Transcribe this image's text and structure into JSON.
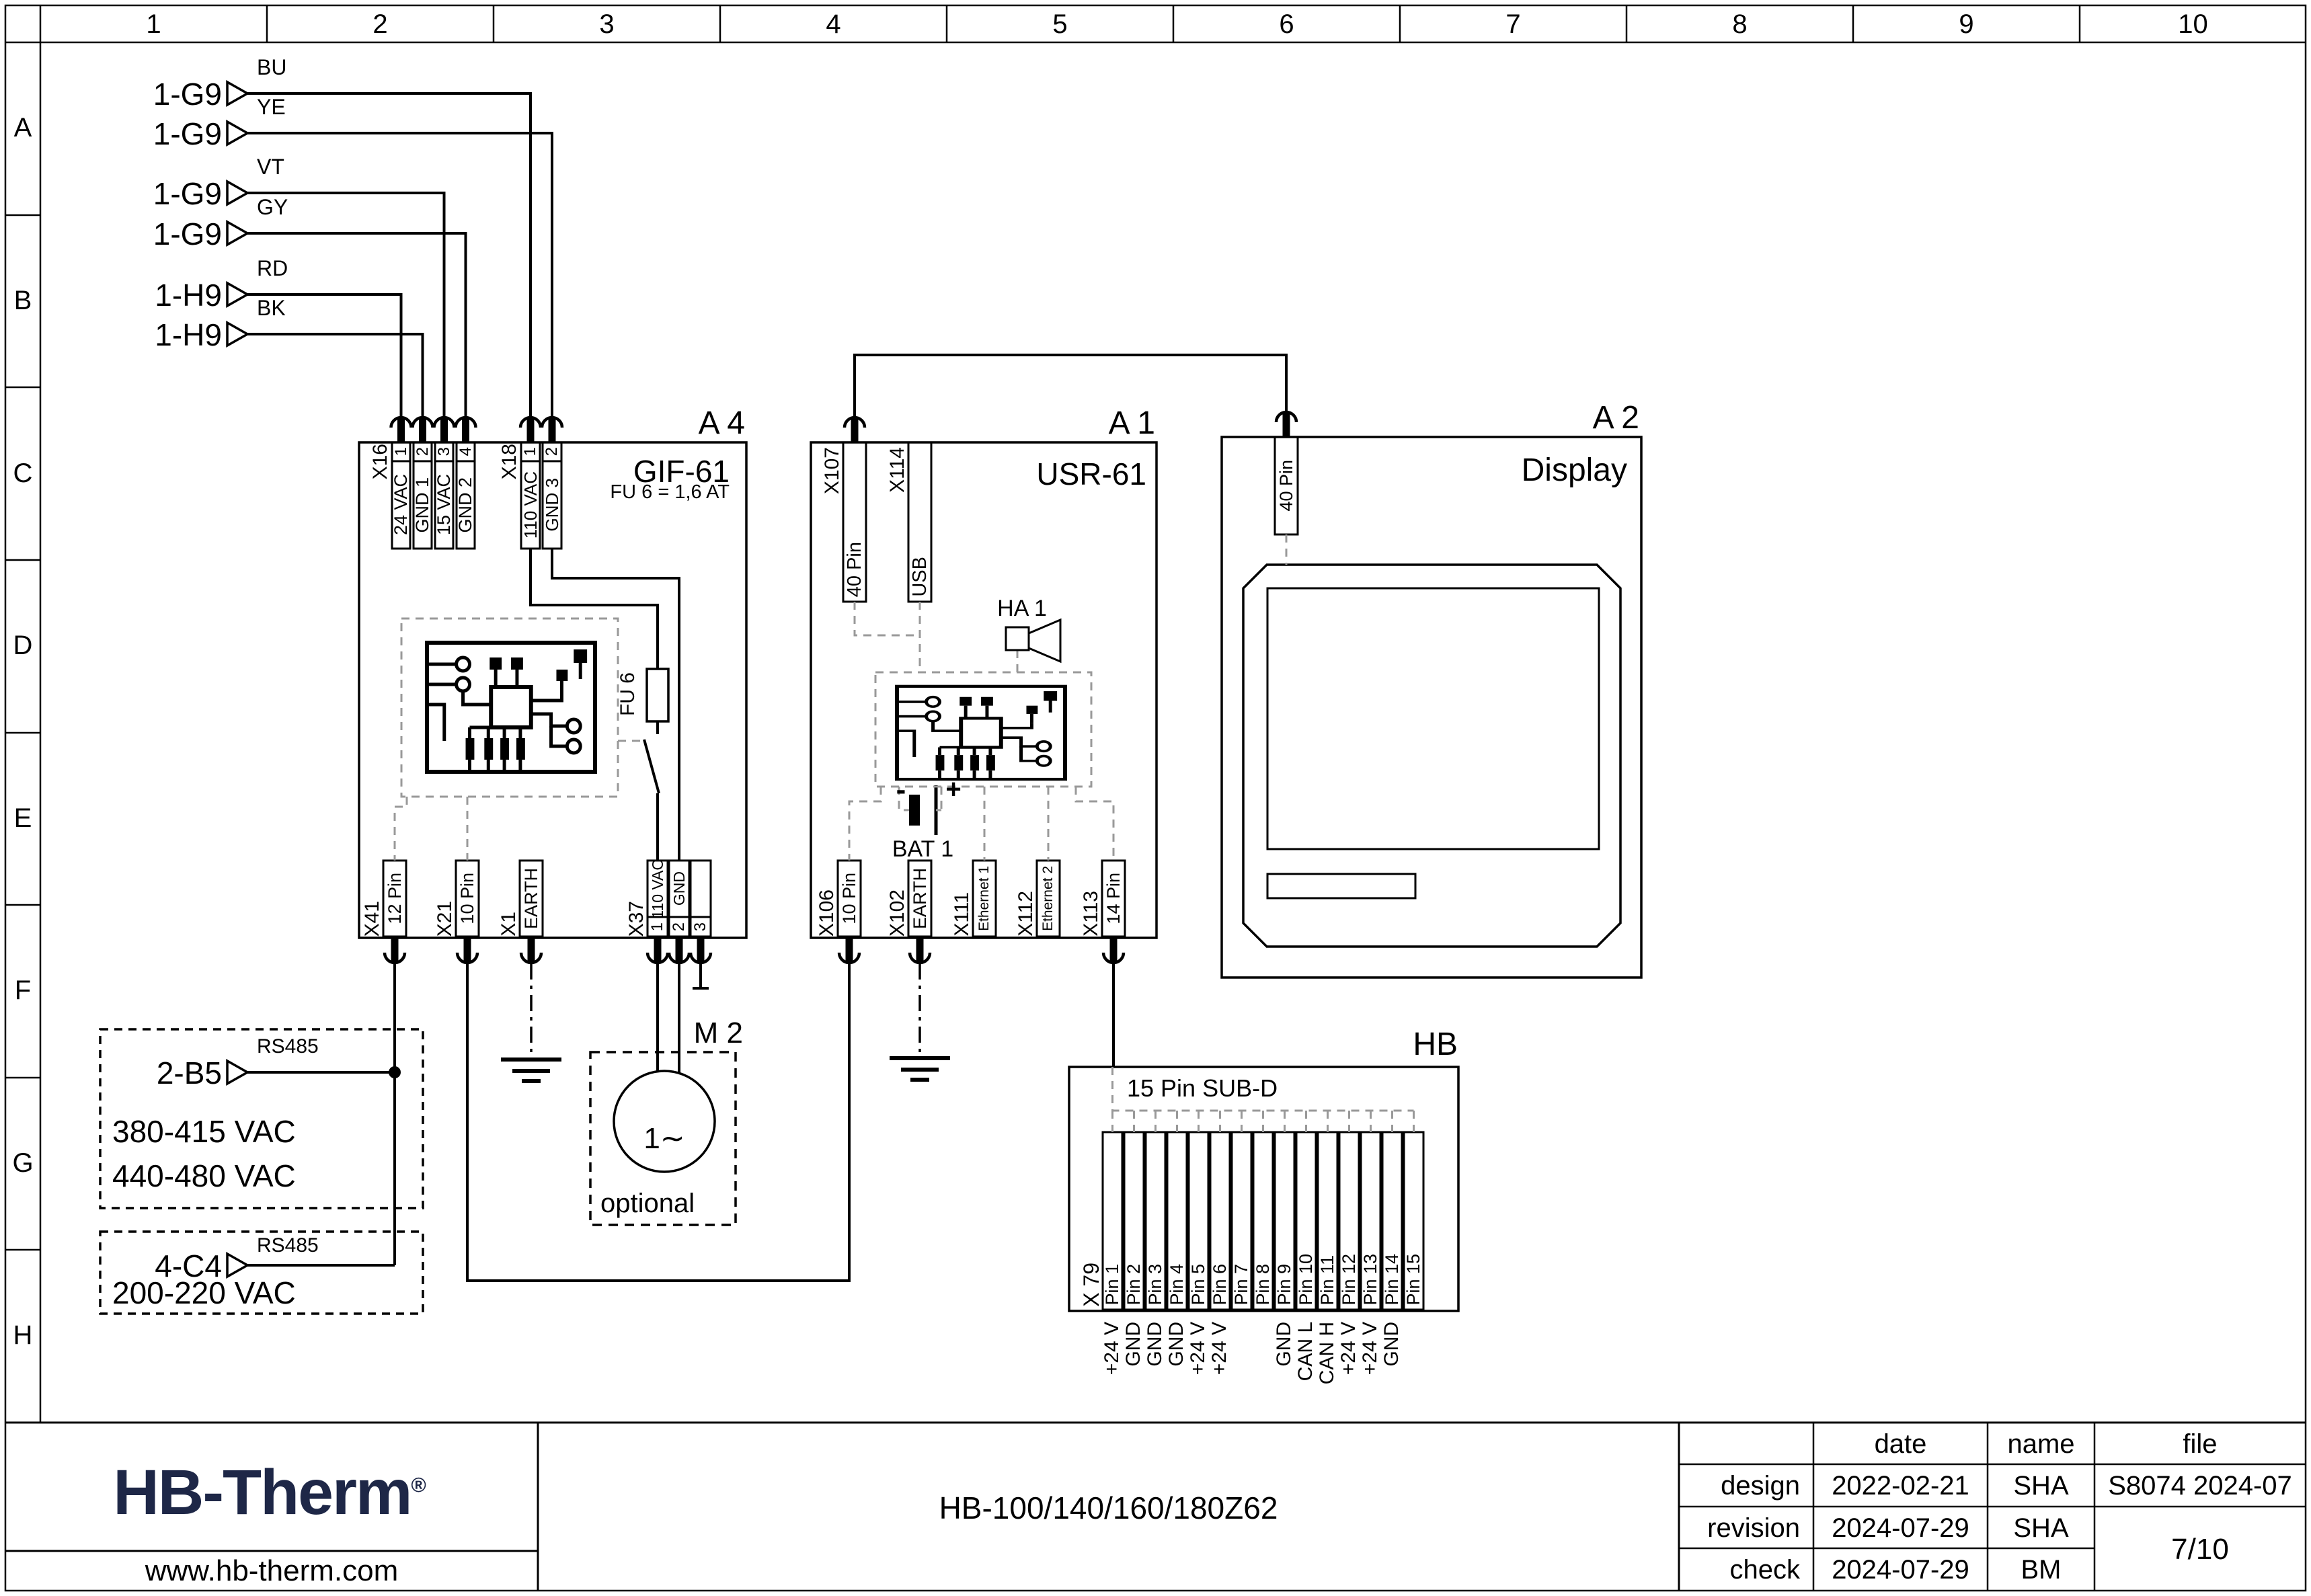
{
  "ruler": {
    "columns": [
      "1",
      "2",
      "3",
      "4",
      "5",
      "6",
      "7",
      "8",
      "9",
      "10"
    ],
    "rows": [
      "A",
      "B",
      "C",
      "D",
      "E",
      "F",
      "G",
      "H"
    ]
  },
  "inputs": [
    {
      "ref": "1-G9",
      "code": "BU"
    },
    {
      "ref": "1-G9",
      "code": "YE"
    },
    {
      "ref": "1-G9",
      "code": "VT"
    },
    {
      "ref": "1-G9",
      "code": "GY"
    },
    {
      "ref": "1-H9",
      "code": "RD"
    },
    {
      "ref": "1-H9",
      "code": "BK"
    }
  ],
  "a4": {
    "designator": "A 4",
    "model": "GIF-61",
    "fuse_note": "FU 6 = 1,6 AT",
    "fuse_label": "FU 6",
    "x16": {
      "label": "X16",
      "pin_numbers": [
        "1",
        "2",
        "3",
        "4"
      ],
      "pin_names": [
        "24 VAC",
        "GND 1",
        "15 VAC",
        "GND 2"
      ]
    },
    "x18": {
      "label": "X18",
      "pin_numbers": [
        "1",
        "2"
      ],
      "pin_names": [
        "110 VAC",
        "GND 3"
      ]
    },
    "x41": {
      "label": "X41",
      "name": "12 Pin"
    },
    "x21": {
      "label": "X21",
      "name": "10 Pin"
    },
    "x1": {
      "label": "X1",
      "name": "EARTH"
    },
    "x37": {
      "label": "X37",
      "pin_numbers": [
        "1",
        "2",
        "3"
      ],
      "pin_names": [
        "110 VAC",
        "GND",
        ""
      ]
    }
  },
  "a1": {
    "designator": "A 1",
    "model": "USR-61",
    "x107": {
      "label": "X107",
      "name": "40 Pin"
    },
    "x114": {
      "label": "X114",
      "name": "USB"
    },
    "ha1": "HA 1",
    "bat1": {
      "label": "BAT 1",
      "minus": "-",
      "plus": "+"
    },
    "x106": {
      "label": "X106",
      "name": "10 Pin"
    },
    "x102": {
      "label": "X102",
      "name": "EARTH"
    },
    "x111": {
      "label": "X111",
      "name": "Ethernet 1"
    },
    "x112": {
      "label": "X112",
      "name": "Ethernet 2"
    },
    "x113": {
      "label": "X113",
      "name": "14 Pin"
    }
  },
  "a2": {
    "designator": "A 2",
    "model": "Display",
    "conn": "40 Pin"
  },
  "m2": {
    "designator": "M 2",
    "symbol": "1∼",
    "note": "optional"
  },
  "hb": {
    "designator": "HB",
    "connector": "15 Pin SUB-D",
    "port": "X 79",
    "pins": [
      "Pin 1",
      "Pin 2",
      "Pin 3",
      "Pin 4",
      "Pin 5",
      "Pin 6",
      "Pin 7",
      "Pin 8",
      "Pin 9",
      "Pin 10",
      "Pin 11",
      "Pin 12",
      "Pin 13",
      "Pin 14",
      "Pin 15"
    ],
    "signals": [
      "+24 V",
      "GND",
      "GND",
      "GND",
      "+24 V",
      "+24 V",
      "",
      "",
      "GND",
      "CAN L",
      "CAN H",
      "+24 V",
      "+24 V",
      "GND",
      ""
    ]
  },
  "sources": [
    {
      "ref": "2-B5",
      "bus": "RS485",
      "voltages": [
        "380-415 VAC",
        "440-480 VAC"
      ]
    },
    {
      "ref": "4-C4",
      "bus": "RS485",
      "voltages": [
        "200-220 VAC"
      ]
    }
  ],
  "title_block": {
    "logo": "HB-Therm",
    "logo_reg": "®",
    "website": "www.hb-therm.com",
    "drawing_title": "HB-100/140/160/180Z62",
    "headers": {
      "date": "date",
      "name": "name",
      "file": "file"
    },
    "rows": [
      {
        "label": "design",
        "date": "2022-02-21",
        "name": "SHA"
      },
      {
        "label": "revision",
        "date": "2024-07-29",
        "name": "SHA"
      },
      {
        "label": "check",
        "date": "2024-07-29",
        "name": "BM"
      }
    ],
    "file_value": "S8074 2024-07",
    "page": "7/10"
  }
}
